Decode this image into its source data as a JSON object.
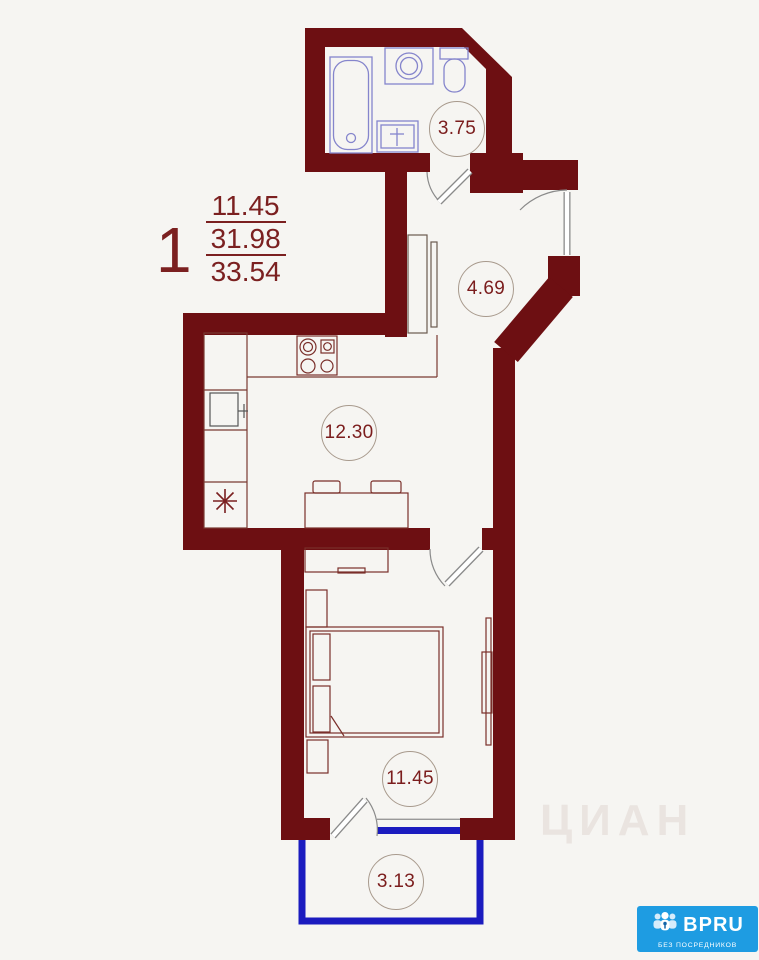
{
  "apartment_label": {
    "number": "1",
    "area_living": "11.45",
    "area_usable": "31.98",
    "area_total": "33.54"
  },
  "room_areas": {
    "bathroom": "3.75",
    "hallway": "4.69",
    "kitchen": "12.30",
    "bedroom": "11.45",
    "balcony": "3.13"
  },
  "watermark": {
    "text": "ЦИАН"
  },
  "logo": {
    "name": "BPRU",
    "tagline": "БЕЗ ПОСРЕДНИКОВ"
  },
  "colors": {
    "wall": "#6d0f12",
    "window_blue": "#1b1bbf",
    "label_text": "#7b1d1d",
    "sanitary_outline": "#8585cc",
    "furniture_outline": "#7a2f2a",
    "logo_bg": "#1e9ce2"
  }
}
